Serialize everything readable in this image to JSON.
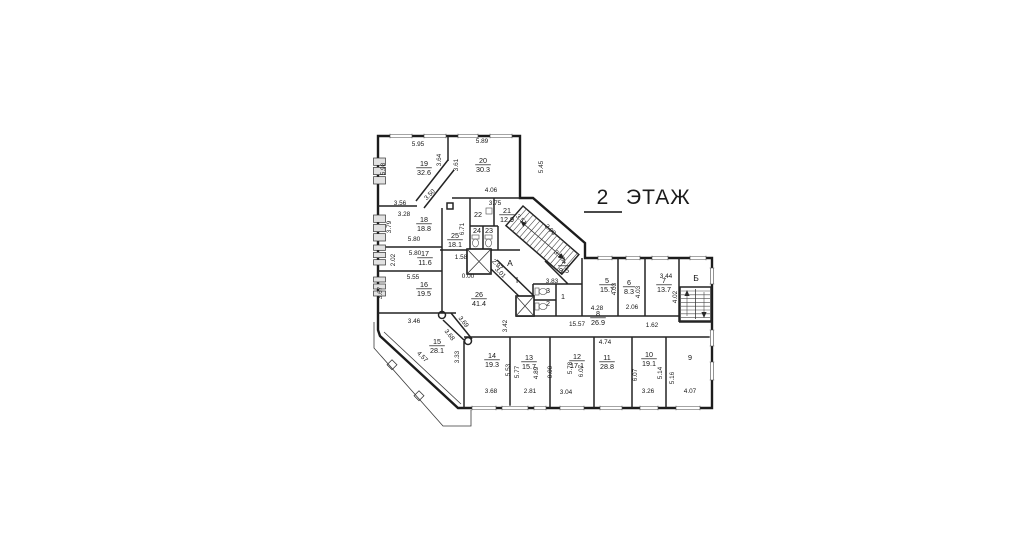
{
  "title": {
    "number": "2",
    "word": "ЭТАЖ"
  },
  "colors": {
    "wall": "#1c1c1c",
    "background": "#ffffff"
  },
  "rooms": [
    {
      "num": "19",
      "area": "32.6",
      "x": 424,
      "y": 166
    },
    {
      "num": "20",
      "area": "30.3",
      "x": 483,
      "y": 163
    },
    {
      "num": "25",
      "area": "18.1",
      "x": 455,
      "y": 238
    },
    {
      "num": "22",
      "area": "",
      "x": 478,
      "y": 217
    },
    {
      "num": "21",
      "area": "12.9",
      "x": 507,
      "y": 213
    },
    {
      "num": "24",
      "area": "",
      "x": 477,
      "y": 233
    },
    {
      "num": "23",
      "area": "",
      "x": 489,
      "y": 233
    },
    {
      "num": "18",
      "area": "18.8",
      "x": 424,
      "y": 222
    },
    {
      "num": "17",
      "area": "11.6",
      "x": 425,
      "y": 256
    },
    {
      "num": "16",
      "area": "19.5",
      "x": 424,
      "y": 287
    },
    {
      "num": "15",
      "area": "28.1",
      "x": 437,
      "y": 344
    },
    {
      "num": "26",
      "area": "41.4",
      "x": 479,
      "y": 297
    },
    {
      "num": "14",
      "area": "19.3",
      "x": 492,
      "y": 358
    },
    {
      "num": "13",
      "area": "15.7",
      "x": 529,
      "y": 360
    },
    {
      "num": "12",
      "area": "17.1",
      "x": 577,
      "y": 359
    },
    {
      "num": "11",
      "area": "28.8",
      "x": 607,
      "y": 360
    },
    {
      "num": "10",
      "area": "19.1",
      "x": 649,
      "y": 357
    },
    {
      "num": "9",
      "area": "",
      "x": 690,
      "y": 360
    },
    {
      "num": "8",
      "area": "26.9",
      "x": 598,
      "y": 316
    },
    {
      "num": "5",
      "area": "15.7",
      "x": 607,
      "y": 283
    },
    {
      "num": "6",
      "area": "8.3",
      "x": 629,
      "y": 285
    },
    {
      "num": "7",
      "area": "13.7",
      "x": 664,
      "y": 283
    },
    {
      "num": "4",
      "area": "9.5",
      "x": 564,
      "y": 264
    },
    {
      "num": "1",
      "area": "",
      "x": 563,
      "y": 299
    },
    {
      "num": "2",
      "area": "",
      "x": 548,
      "y": 306
    },
    {
      "num": "3",
      "area": "",
      "x": 548,
      "y": 293
    }
  ],
  "stair_letters": [
    {
      "t": "А",
      "x": 510,
      "y": 266
    },
    {
      "t": "Б",
      "x": 696,
      "y": 281
    },
    {
      "t": "I",
      "x": 517,
      "y": 283
    }
  ],
  "dimensions": [
    {
      "t": "5.95",
      "x": 418,
      "y": 146,
      "r": 0
    },
    {
      "t": "5.89",
      "x": 482,
      "y": 143,
      "r": 0
    },
    {
      "t": "5.98",
      "x": 385,
      "y": 169,
      "r": -90
    },
    {
      "t": "3.64",
      "x": 441,
      "y": 160,
      "r": -90
    },
    {
      "t": "3.61",
      "x": 458,
      "y": 165,
      "r": -90
    },
    {
      "t": "5.45",
      "x": 543,
      "y": 167,
      "r": -90
    },
    {
      "t": "3.56",
      "x": 400,
      "y": 205,
      "r": 0
    },
    {
      "t": "3.28",
      "x": 404,
      "y": 216,
      "r": 0
    },
    {
      "t": "3.50",
      "x": 431,
      "y": 196,
      "r": -45
    },
    {
      "t": "4.06",
      "x": 491,
      "y": 192,
      "r": 0
    },
    {
      "t": "3.75",
      "x": 495,
      "y": 205,
      "r": 0
    },
    {
      "t": "3.79",
      "x": 391,
      "y": 227,
      "r": -90
    },
    {
      "t": "6.71",
      "x": 464,
      "y": 229,
      "r": -90
    },
    {
      "t": "5.80",
      "x": 414,
      "y": 241,
      "r": 0
    },
    {
      "t": "5.80",
      "x": 415,
      "y": 255,
      "r": 0
    },
    {
      "t": "2.02",
      "x": 395,
      "y": 260,
      "r": -90
    },
    {
      "t": "5.55",
      "x": 413,
      "y": 279,
      "r": 0
    },
    {
      "t": "3.67",
      "x": 382,
      "y": 293,
      "r": -90
    },
    {
      "t": "1.58",
      "x": 461,
      "y": 259,
      "r": 0
    },
    {
      "t": "0.00",
      "x": 468,
      "y": 278,
      "r": 0
    },
    {
      "t": "3.51",
      "x": 520,
      "y": 221,
      "r": 45
    },
    {
      "t": "2.90",
      "x": 549,
      "y": 231,
      "r": 45
    },
    {
      "t": "3.58",
      "x": 558,
      "y": 257,
      "r": 45
    },
    {
      "t": "2.97",
      "x": 496,
      "y": 266,
      "r": 45
    },
    {
      "t": "3.01",
      "x": 499,
      "y": 274,
      "r": 45
    },
    {
      "t": "3.83",
      "x": 552,
      "y": 283,
      "r": 0
    },
    {
      "t": "3.46",
      "x": 414,
      "y": 323,
      "r": 0
    },
    {
      "t": "3.69",
      "x": 462,
      "y": 323,
      "r": 52
    },
    {
      "t": "3.68",
      "x": 448,
      "y": 336,
      "r": 52
    },
    {
      "t": "4.57",
      "x": 421,
      "y": 358,
      "r": 45
    },
    {
      "t": "3.33",
      "x": 459,
      "y": 357,
      "r": -90
    },
    {
      "t": "3.42",
      "x": 507,
      "y": 326,
      "r": -90
    },
    {
      "t": "3.44",
      "x": 666,
      "y": 278,
      "r": 0
    },
    {
      "t": "4.03",
      "x": 616,
      "y": 289,
      "r": -90
    },
    {
      "t": "4.03",
      "x": 640,
      "y": 292,
      "r": -90
    },
    {
      "t": "4.02",
      "x": 677,
      "y": 297,
      "r": -90
    },
    {
      "t": "4.28",
      "x": 597,
      "y": 310,
      "r": 0
    },
    {
      "t": "2.06",
      "x": 632,
      "y": 309,
      "r": 0
    },
    {
      "t": "15.57",
      "x": 577,
      "y": 326,
      "r": 0
    },
    {
      "t": "1.62",
      "x": 652,
      "y": 327,
      "r": 0
    },
    {
      "t": "4.74",
      "x": 605,
      "y": 344,
      "r": 0
    },
    {
      "t": "5.53",
      "x": 510,
      "y": 370,
      "r": -90
    },
    {
      "t": "5.77",
      "x": 519,
      "y": 372,
      "r": -90
    },
    {
      "t": "4.89",
      "x": 538,
      "y": 373,
      "r": -90
    },
    {
      "t": "0.00",
      "x": 552,
      "y": 372,
      "r": -90
    },
    {
      "t": "5.78",
      "x": 572,
      "y": 368,
      "r": -90
    },
    {
      "t": "6.07",
      "x": 583,
      "y": 371,
      "r": -90
    },
    {
      "t": "6.07",
      "x": 637,
      "y": 375,
      "r": -90
    },
    {
      "t": "5.14",
      "x": 662,
      "y": 373,
      "r": -90
    },
    {
      "t": "5.16",
      "x": 674,
      "y": 378,
      "r": -90
    },
    {
      "t": "3.68",
      "x": 491,
      "y": 393,
      "r": 0
    },
    {
      "t": "2.81",
      "x": 530,
      "y": 393,
      "r": 0
    },
    {
      "t": "3.04",
      "x": 566,
      "y": 394,
      "r": 0
    },
    {
      "t": "3.26",
      "x": 648,
      "y": 393,
      "r": 0
    },
    {
      "t": "4.07",
      "x": 690,
      "y": 393,
      "r": 0
    }
  ]
}
